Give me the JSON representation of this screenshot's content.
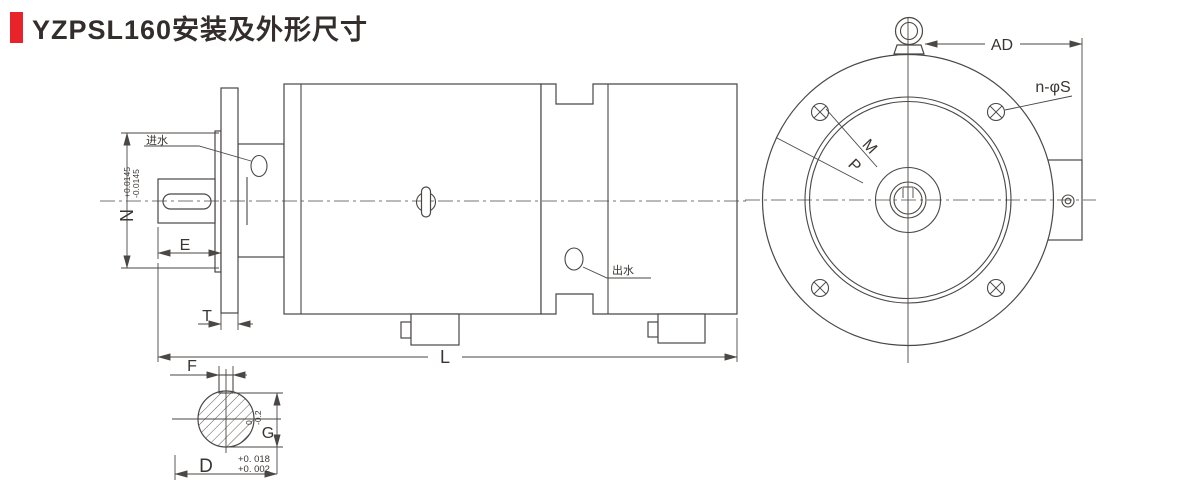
{
  "title": {
    "text": "YZPSL160安装及外形尺寸"
  },
  "colors": {
    "accent_red": "#e8232a",
    "line": "#4a4745",
    "text": "#3a3531"
  },
  "side_view": {
    "inlet_label": "进水",
    "outlet_label": "出水",
    "dims": {
      "n": "N",
      "n_tol_upper": "+0.0145",
      "n_tol_lower": "-0.0145",
      "e": "E",
      "t": "T",
      "l": "L",
      "f": "F"
    }
  },
  "shaft_section": {
    "dims": {
      "d": "D",
      "d_tol_upper": "+0. 018",
      "d_tol_lower": "+0. 002",
      "g": "G",
      "g_tol_upper": "0",
      "g_tol_lower": "-0.2"
    }
  },
  "front_view": {
    "dims": {
      "ad": "AD",
      "mount_holes": "n-φS",
      "m": "M",
      "p": "P"
    }
  }
}
